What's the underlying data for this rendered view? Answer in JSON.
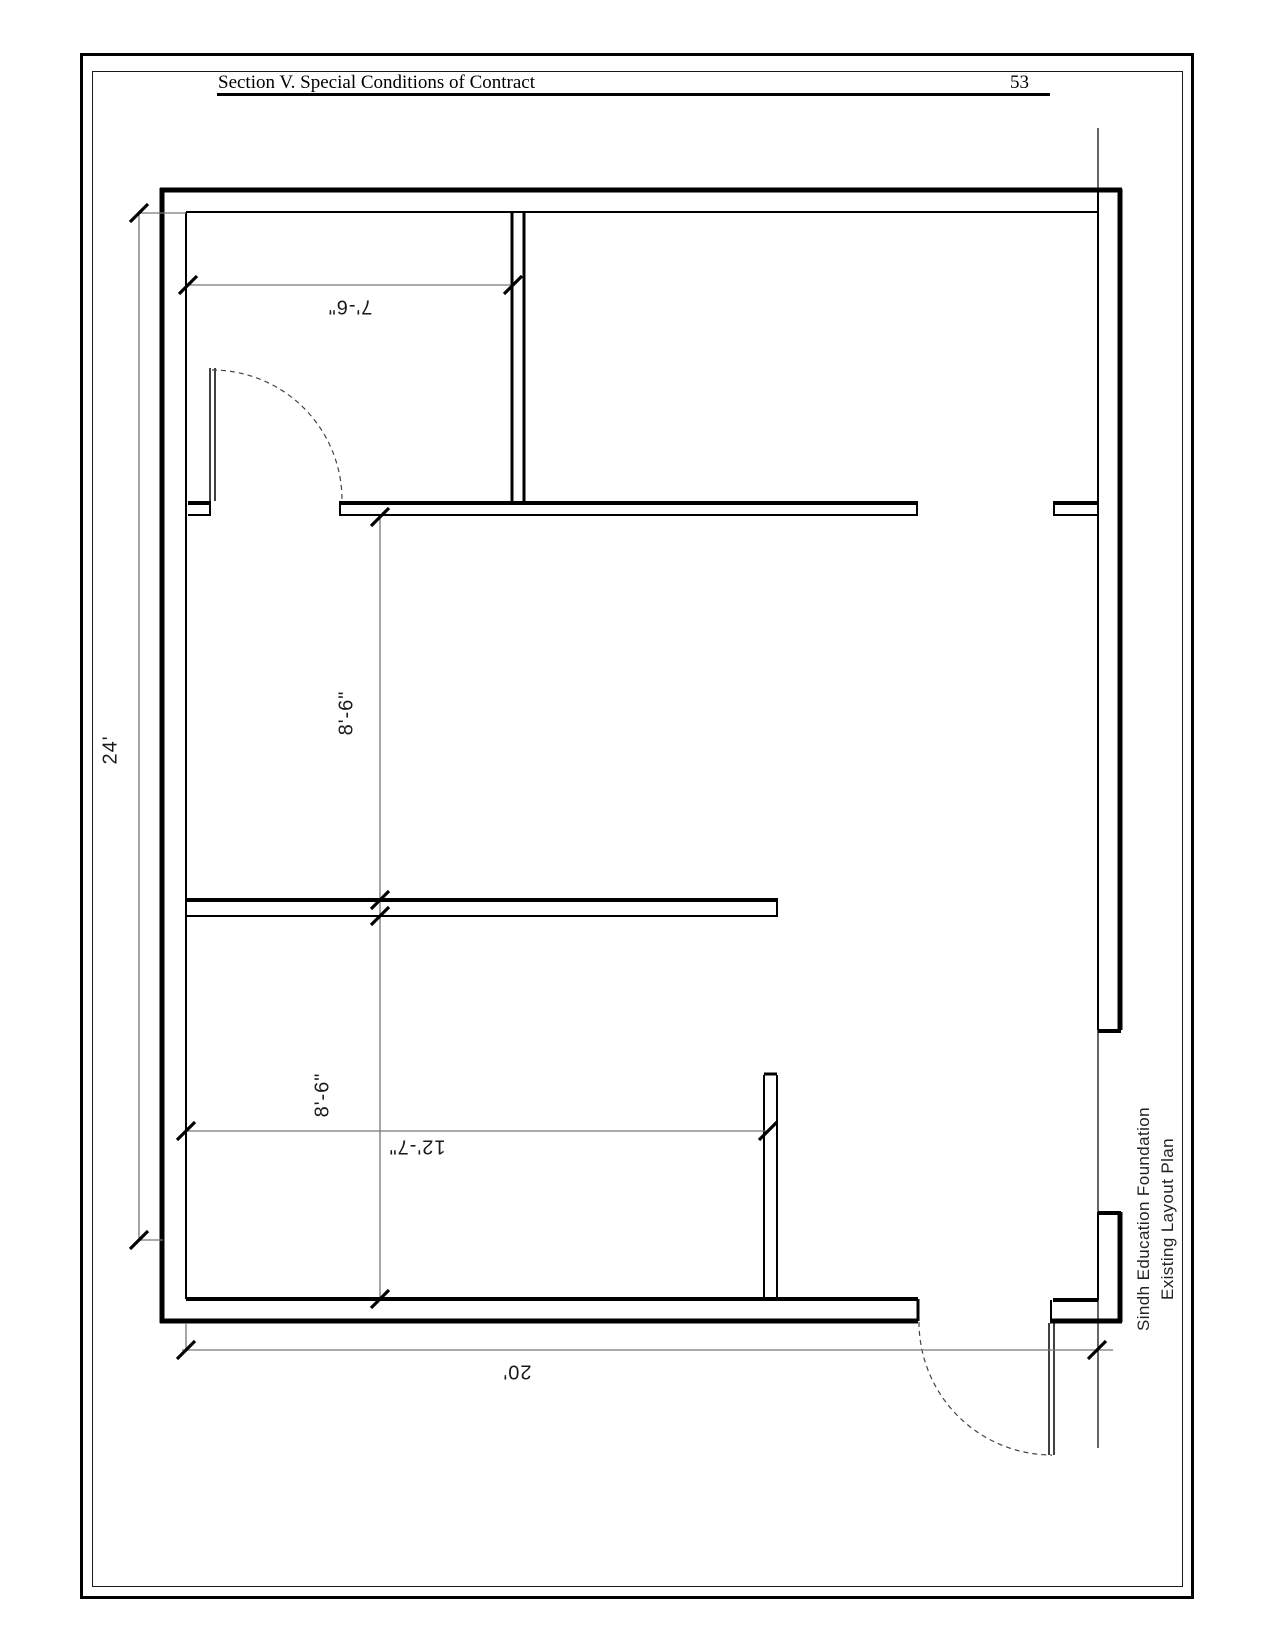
{
  "header": {
    "title": "Section V. Special Conditions of Contract",
    "page_number": "53"
  },
  "plan": {
    "dim_total_height": "24'",
    "dim_room_width": "7'-6\"",
    "dim_bay_upper": "8'-6\"",
    "dim_bay_lower": "8'-6\"",
    "dim_lower_room_width": "12'-7\"",
    "dim_total_width": "20'",
    "caption_line1": "Sindh Education Foundation",
    "caption_line2": "Existing Layout Plan"
  }
}
